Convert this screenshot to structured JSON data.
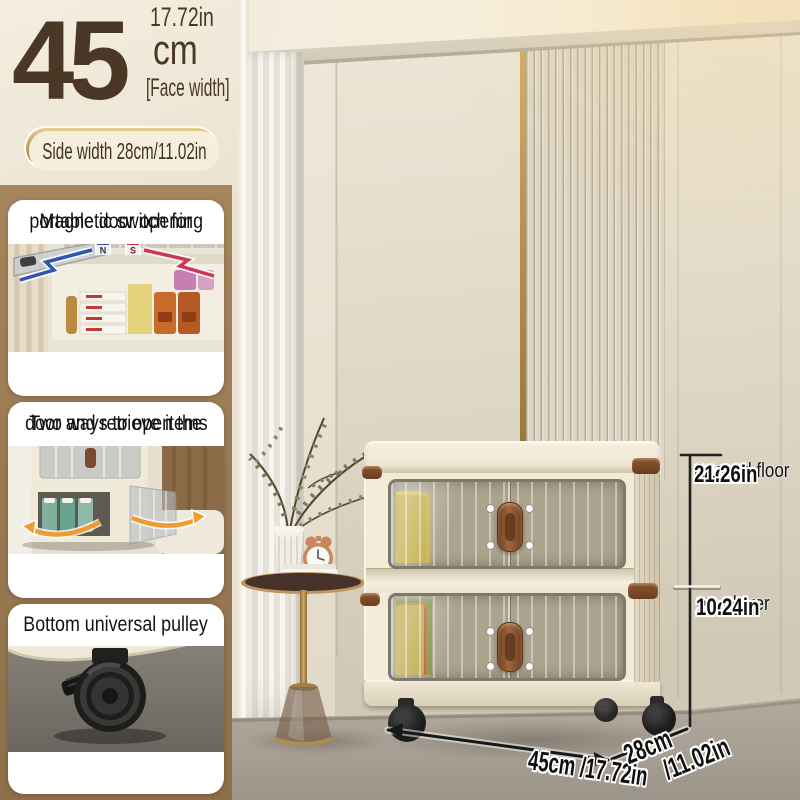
{
  "header": {
    "big_number": "45",
    "unit": "cm",
    "inches": "17.72in",
    "face_width": "[Face width]",
    "side_width_badge": "Side width 28cm/11.02in"
  },
  "features": [
    {
      "icon": "magnet-icon",
      "lines": [
        "Magnetic switch for",
        "portable door opening"
      ]
    },
    {
      "icon": "open-arrows-icon",
      "lines": [
        "Two ways to open the",
        "door and retrieve items"
      ]
    },
    {
      "icon": "caster-wheel-icon",
      "lines": [
        "Bottom universal pulley"
      ]
    }
  ],
  "annotations": {
    "second_floor": {
      "label": "Second floor",
      "cm": "54cm",
      "in": "21.26in"
    },
    "one_layer": {
      "label": "One layer",
      "cm": "26cm",
      "in": "10.24in"
    },
    "width": "45cm /17.72in",
    "depth": {
      "line1": "28cm",
      "line2": "/11.02in"
    }
  },
  "icons": {
    "magnet_n": "N",
    "magnet_s": "S"
  },
  "colors": {
    "accent_gold": "#b08c4e",
    "text_brown": "#4a3726",
    "magnet_blue": "#3a4fa0",
    "magnet_red": "#c42a50",
    "arrow_orange": "#f09a30",
    "wall_cream": "#e9e2d2",
    "floor_gray": "#a9a198",
    "sidebar_tan": "#997a52",
    "product_cream": "#f1ebd8",
    "handle_brown": "#7c4a28",
    "annotation_black": "#161616"
  }
}
